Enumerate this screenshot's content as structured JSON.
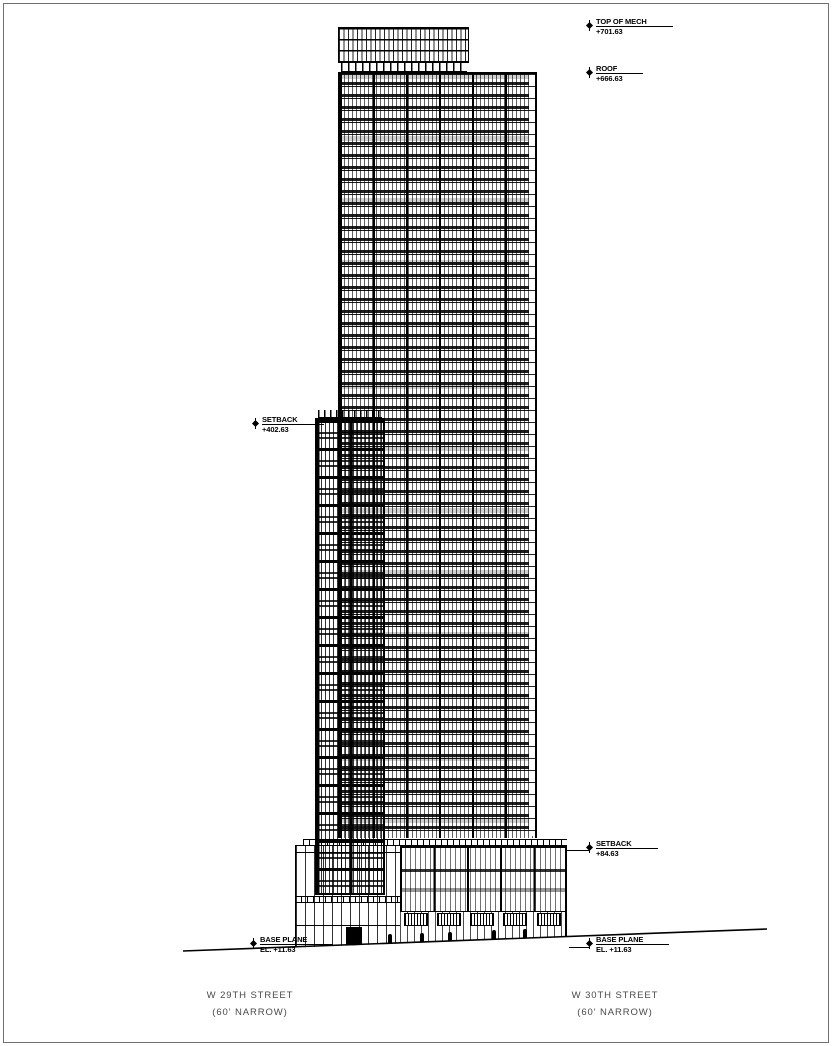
{
  "drawing": {
    "type": "architectural-elevation",
    "markers": [
      {
        "id": "top-of-mech",
        "label": "TOP OF MECH",
        "value": "+701.63"
      },
      {
        "id": "roof",
        "label": "ROOF",
        "value": "+666.63"
      },
      {
        "id": "setback-upper",
        "label": "SETBACK",
        "value": "+402.63"
      },
      {
        "id": "setback-lower",
        "label": "SETBACK",
        "value": "+84.63"
      },
      {
        "id": "base-plane-left",
        "label": "BASE PLANE",
        "value": "EL. +11.63"
      },
      {
        "id": "base-plane-right",
        "label": "BASE PLANE",
        "value": "EL. +11.63"
      }
    ],
    "streets": [
      {
        "name": "W 29TH STREET",
        "note": "(60' NARROW)"
      },
      {
        "name": "W 30TH STREET",
        "note": "(60' NARROW)"
      }
    ],
    "colors": {
      "line": "#000000",
      "street_label": "#4a4a4a",
      "frame": "#6e6e73",
      "background": "#ffffff"
    }
  }
}
